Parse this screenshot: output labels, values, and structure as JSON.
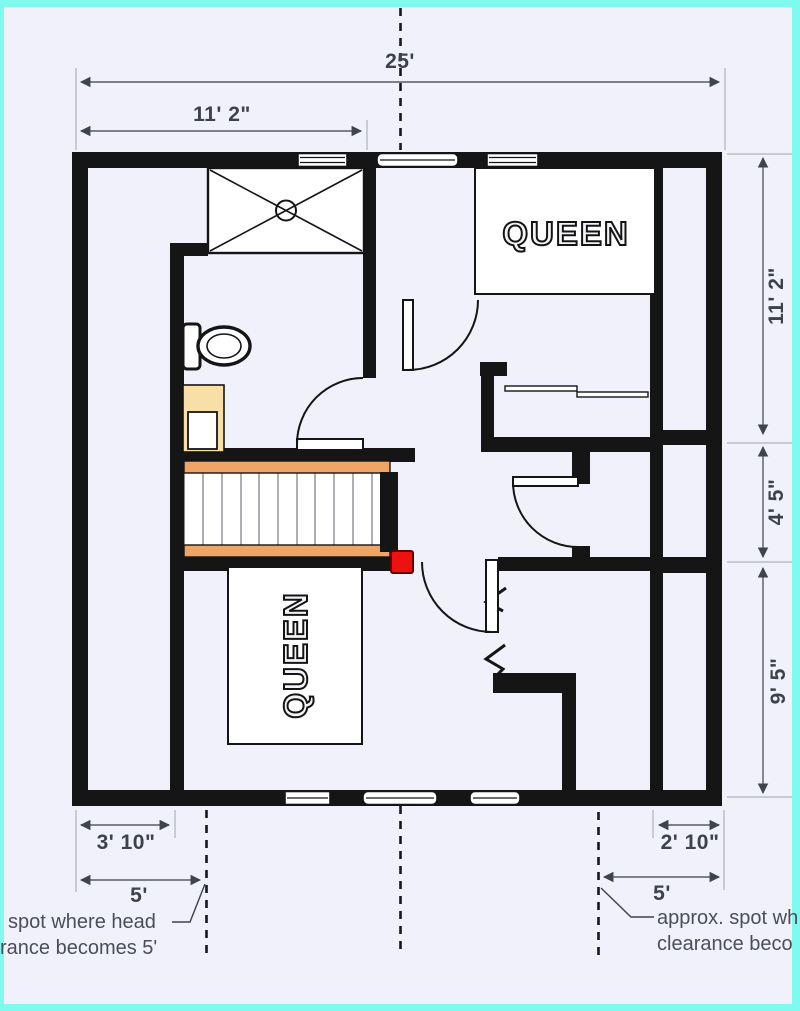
{
  "colors": {
    "bg": "#f0f1fb",
    "frame": "#7efbee",
    "wall": "#151515",
    "stair_rail": "#efa566",
    "vanity": "#f8dfa8",
    "marker_red": "#ee1111",
    "dim_text": "#3d414b",
    "dim_line": "#565a64",
    "ann_text": "#4a4e57"
  },
  "floor_plan": {
    "beds": {
      "top_right": "QUEEN",
      "bottom_left": "QUEEN"
    },
    "dimensions": {
      "overall_width": "25'",
      "upper_left_width": "11' 2\"",
      "right_upper_height": "11' 2\"",
      "right_middle_height": "4' 5\"",
      "right_lower_height": "9' 5\"",
      "lower_left_width": "3' 10\"",
      "lower_left_clearance": "5'",
      "lower_right_width": "2' 10\"",
      "lower_right_clearance": "5'"
    },
    "annotations": {
      "left": {
        "line1": "spot where head",
        "line2": "rance becomes 5'"
      },
      "right": {
        "line1": "approx. spot wh",
        "line2": "clearance beco"
      }
    }
  }
}
